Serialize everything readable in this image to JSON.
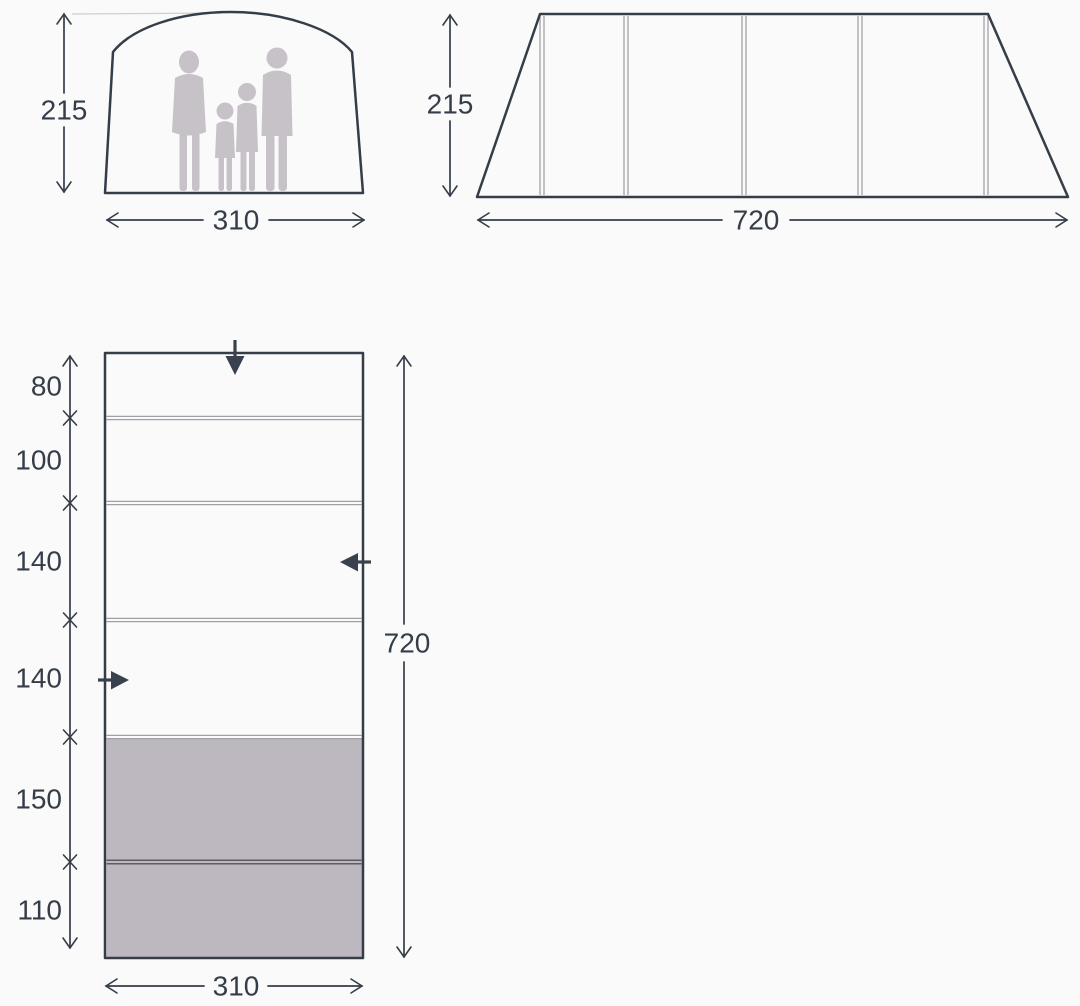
{
  "front_view": {
    "name": "tent front elevation with family silhouette",
    "height_label": "215",
    "width_label": "310"
  },
  "side_view": {
    "name": "tent side elevation with 4 panels",
    "height_label": "215",
    "length_label": "720"
  },
  "floor_plan": {
    "name": "tent floor plan",
    "segments": [
      {
        "label": "80"
      },
      {
        "label": "100"
      },
      {
        "label": "140"
      },
      {
        "label": "140"
      },
      {
        "label": "150"
      },
      {
        "label": "110"
      }
    ],
    "total_length_label": "720",
    "width_label": "310",
    "shaded_segment_labels": [
      "150",
      "110"
    ]
  },
  "colors": {
    "background": "#fafafa",
    "line": "#353d49",
    "silhouette": "#c6c2c8",
    "shaded_room": "#bdb8bf",
    "divider": "#a19ea6",
    "dark_divider": "#5f5c63"
  }
}
